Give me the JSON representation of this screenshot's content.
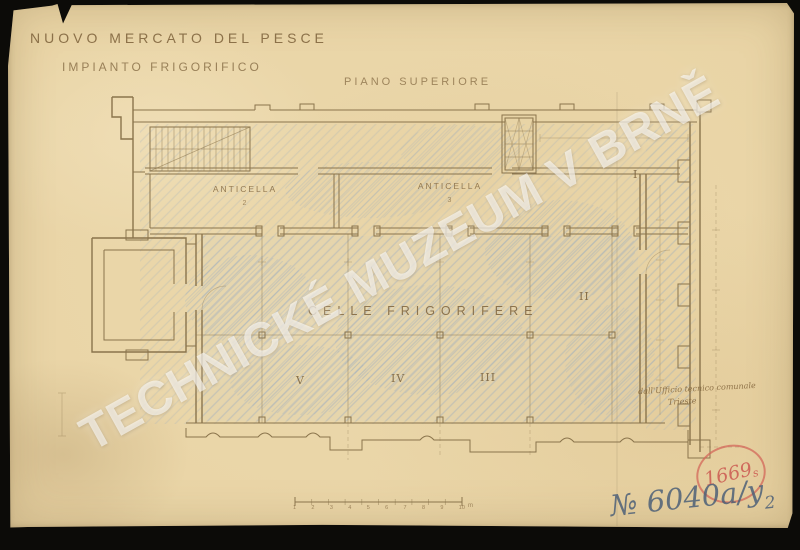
{
  "colors": {
    "bg": "#0c0b08",
    "paper": "#e9d4a5",
    "ink": "#8a744c",
    "hatch": "#92a8c0",
    "stamp": "#cf6a5c",
    "pen": "#4d6078",
    "watermark_color": "#ffffff"
  },
  "document": {
    "title_line1": "NUOVO MERCATO DEL PESCE",
    "title_line2": "IMPIANTO FRIGORIFICO",
    "plan_caption": "PIANO SUPERIORE"
  },
  "plan": {
    "rooms": {
      "anticella_left_label": "ANTICELLA",
      "anticella_left_no": "2",
      "anticella_right_label": "ANTICELLA",
      "anticella_right_no": "3",
      "main_hall_label": "CELLE FRIGORIFERE",
      "cells": [
        "I",
        "II",
        "III",
        "IV",
        "V"
      ]
    },
    "scale_bar": {
      "ticks": [
        "1",
        "2",
        "3",
        "4",
        "5",
        "6",
        "7",
        "8",
        "9",
        "10"
      ],
      "unit": "m"
    }
  },
  "annotations": {
    "watermark": "TECHNICKÉ MUZEUM V BRNĚ",
    "stamp_number": "1669",
    "stamp_suffix": "s",
    "note_line1": "dall'Ufficio tecnico comunale",
    "note_line2": "Trieste",
    "inventory_prefix": "№ ",
    "inventory_number": "6040a/y",
    "inventory_sub": "2"
  }
}
